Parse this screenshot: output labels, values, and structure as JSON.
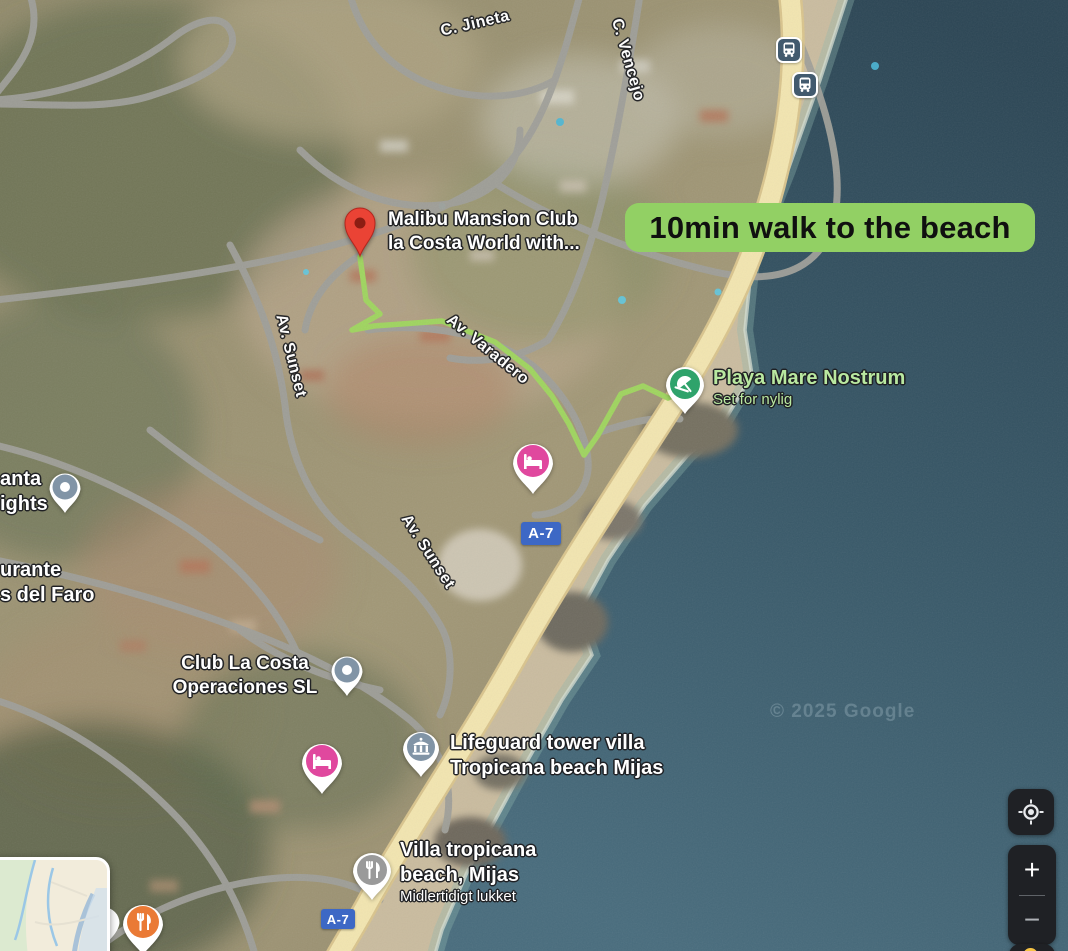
{
  "banner": {
    "text": "10min walk to the beach"
  },
  "attribution": "© 2025 Google",
  "road_shields": {
    "a7": "A-7"
  },
  "streets": {
    "jineta": "C. Jineta",
    "vencejo": "C. Vencejo",
    "sunset1": "Av. Sunset",
    "sunset2": "Av. Sunset",
    "varadero": "Av. Varadero"
  },
  "pois": {
    "malibu": {
      "line1": "Malibu Mansion Club",
      "line2": "la Costa World with..."
    },
    "playa": {
      "name": "Playa Mare Nostrum",
      "status": "Set for nylig"
    },
    "club": {
      "line1": "Club La Costa",
      "line2": "Operaciones SL"
    },
    "lifeguard": {
      "line1": "Lifeguard tower villa",
      "line2": "Tropicana beach Mijas"
    },
    "villa": {
      "line1": "Villa tropicana",
      "line2": "beach, Mijas",
      "status": "Midlertidigt lukket"
    },
    "left_partial_top": {
      "line1": "anta",
      "line2": "ights"
    },
    "left_partial_bottom": {
      "line1": "urante",
      "line2": "s del Faro"
    }
  },
  "controls": {
    "zoom_in": "+",
    "zoom_out": "−"
  },
  "colors": {
    "banner_green": "#92d064",
    "route_green": "#9fd45f",
    "beach_poi_green": "#2fa36b",
    "lodging_pink": "#e0489e",
    "restaurant_orange": "#ea7a35",
    "transit_slate": "#425a6e",
    "shield_blue": "#3d68c5",
    "pin_red": "#ea4335"
  }
}
